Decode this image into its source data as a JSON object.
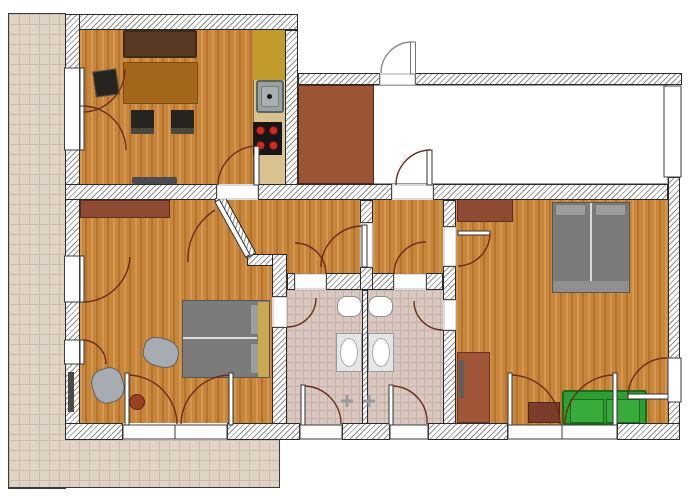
{
  "rooms": {
    "balkon": {
      "label": "Balkon"
    },
    "kueche_wohnen": {
      "label": "Küche - Wohnen"
    },
    "gang": {
      "label": "Gang"
    },
    "vorzimmer1": {
      "label": "Vorzimmer"
    },
    "vorzimmer2": {
      "label": "Vorzimmer"
    },
    "schlafzimmer1": {
      "label": "Schlafzimmer 1"
    },
    "schlafzimmer2": {
      "label": "Schlafzimmer 2"
    },
    "bad1": {
      "label": "Bad/WC"
    },
    "bad2": {
      "label": "Bad/WC"
    }
  },
  "colors": {
    "wood": "#c8853c",
    "wood-dark": "#b5732c",
    "wood-light": "#d49750",
    "hatch": "#8d8d8d",
    "wall-border": "#2a2a2a",
    "balcony-tile": "#ded3c5",
    "balcony-line": "#ccbdab",
    "balcony-border": "#3a3a3a",
    "bath-tile": "#d9c8c0",
    "bath-line": "#c7b1a8",
    "gang-floor": "#ffffff",
    "entry-brown": "#9b5434",
    "counter-tan": "#d8c28f",
    "counter-olive": "#c19b2d",
    "sofa-brown": "#5a3a25",
    "sofa-brown-dark": "#402a18",
    "table-brown": "#a3661b",
    "chair-black": "#26241e",
    "bed-gray": "#7b7b7b",
    "bed-light": "#9d9d9d",
    "pillow-tan": "#c9a952",
    "furniture-redbrown": "#8e4a33",
    "cabinet-brown": "#a05538",
    "sidetable-brown": "#7b3c2b",
    "sofa-green": "#2f9e32",
    "sofa-green-dark": "#1a6b1d",
    "pouf-gray": "#a7abb2",
    "stool-rust": "#9c4020",
    "door-arc": "#6b2d18",
    "door-arc-gray": "#8a8a8a",
    "stove-black": "#161616",
    "burner-red": "#cf2b20",
    "sink-gray": "#9aa0a0",
    "label-color": "#14141e",
    "fixture-white": "#ffffff"
  }
}
